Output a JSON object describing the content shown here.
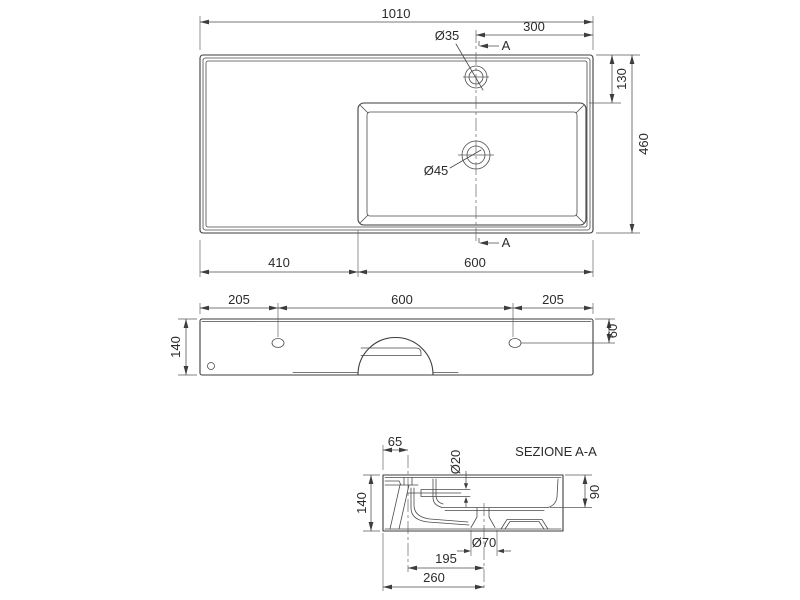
{
  "drawing": {
    "background": "#ffffff",
    "line_color": "#3d3d3d",
    "text_color": "#2b2b2b",
    "top_view": {
      "overall_width": "1010",
      "faucet_offset_right": "300",
      "faucet_hole_dia": "Ø35",
      "deck_depth": "130",
      "overall_depth": "460",
      "drain_hole_dia": "Ø45",
      "left_section_width": "410",
      "basin_section_width": "600",
      "section_marker": "A"
    },
    "front_view": {
      "left_hole_offset": "205",
      "hole_spacing": "600",
      "right_hole_offset": "205",
      "height": "140",
      "hole_top_offset": "60"
    },
    "section_view": {
      "title": "SEZIONE A-A",
      "faucet_offset": "65",
      "overflow_dia": "Ø20",
      "height": "140",
      "bowl_depth": "90",
      "drain_dia": "Ø70",
      "faucet_to_drain": "195",
      "wall_to_drain": "260"
    }
  }
}
